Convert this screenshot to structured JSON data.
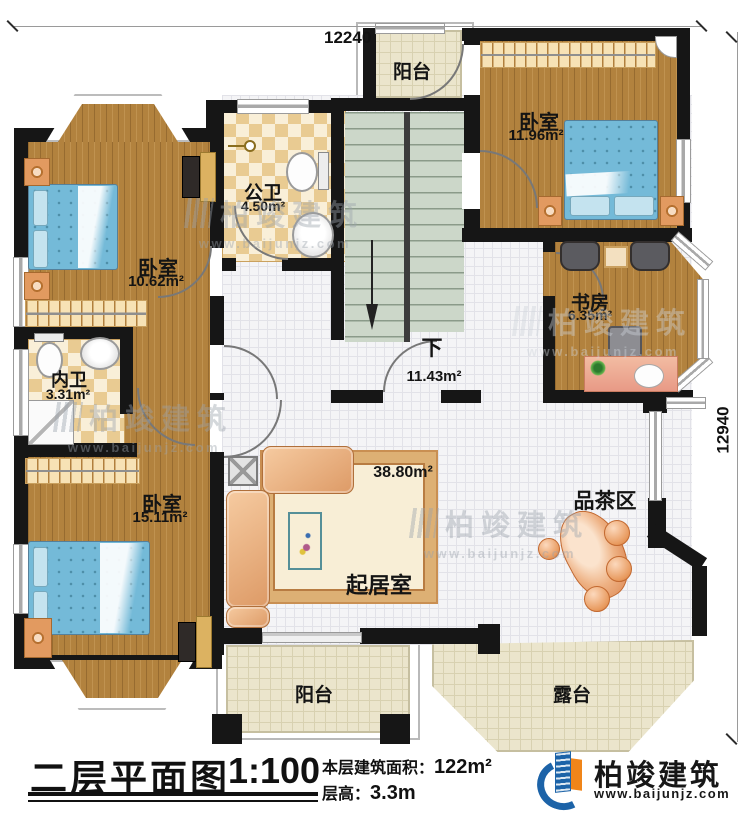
{
  "dimensions": {
    "top": "12240",
    "right": "12940"
  },
  "rooms": {
    "bedroom_tl": {
      "label": "卧室",
      "area": "10.62m²"
    },
    "bath_public": {
      "label": "公卫",
      "area": "4.50m²"
    },
    "balcony_top": {
      "label": "阳台"
    },
    "bedroom_tr": {
      "label": "卧室",
      "area": "11.96m²"
    },
    "study": {
      "label": "书房",
      "area": "6.35m²"
    },
    "stair_hall": {
      "label": "下",
      "area": "11.43m²"
    },
    "bath_inner": {
      "label": "内卫",
      "area": "3.31m²"
    },
    "bedroom_bl": {
      "label": "卧室",
      "area": "15.11m²"
    },
    "living": {
      "label": "起居室",
      "area": "38.80m²"
    },
    "tea_area": {
      "label": "品茶区"
    },
    "balcony_bottom": {
      "label": "阳台"
    },
    "terrace": {
      "label": "露台"
    }
  },
  "titleblock": {
    "title": "二层平面图",
    "scale": "1:100",
    "area_label": "本层建筑面积：",
    "area_value": "122m²",
    "height_label": "层高：",
    "height_value": "3.3m"
  },
  "brand": {
    "name": "柏竣建筑",
    "website": "www.baijunjz.com"
  },
  "watermark": {
    "name": "柏竣建筑",
    "website": "www.baijunjz.com"
  },
  "colors": {
    "wall": "#161616",
    "wood": "#b2823e",
    "bed_blue": "#74bad8",
    "checker_tile": "#e9cb92",
    "stair_green": "#ccd7c9",
    "balcony_tile": "#ebe5cc",
    "brand_blue": "#1c63a8",
    "brand_orange": "#f08519"
  }
}
